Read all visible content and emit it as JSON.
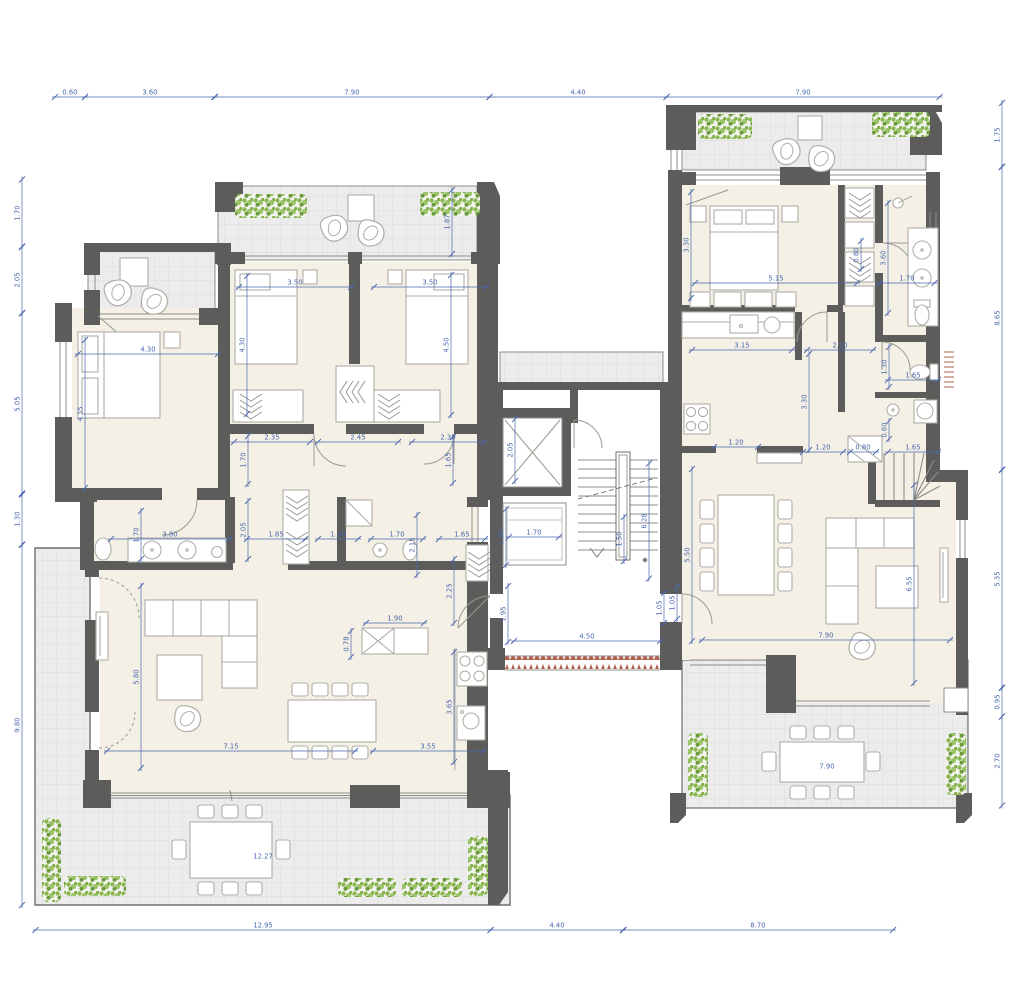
{
  "title": "apartment-floor-plan",
  "colors": {
    "wall": "#5c5c5b",
    "floor": "#f4f0e5",
    "terrace": "#ececec",
    "terrace_grid": "#dcdcdc",
    "furniture_stroke": "#aeaea6",
    "window_line": "#8c8c88",
    "dimension_blue": "#4a68ae",
    "plant_green": "#8ab74f",
    "plant_green_dark": "#6b9a3c",
    "hatch_red": "#b2604e"
  },
  "dimensions": [
    {
      "t": "0.60",
      "x": 70,
      "y": 97,
      "len": 30,
      "v": 0
    },
    {
      "t": "3.60",
      "x": 150,
      "y": 97,
      "len": 130,
      "v": 0
    },
    {
      "t": "7.90",
      "x": 352,
      "y": 97,
      "len": 275,
      "v": 0
    },
    {
      "t": "4.40",
      "x": 578,
      "y": 97,
      "len": 177,
      "v": 0
    },
    {
      "t": "7.90",
      "x": 803,
      "y": 97,
      "len": 273,
      "v": 0
    },
    {
      "t": "12.95",
      "x": 263,
      "y": 930,
      "len": 455,
      "v": 0
    },
    {
      "t": "4.40",
      "x": 557,
      "y": 930,
      "len": 133,
      "v": 0
    },
    {
      "t": "8.70",
      "x": 758,
      "y": 930,
      "len": 270,
      "v": 0
    },
    {
      "t": "1.70",
      "x": 22,
      "y": 213,
      "len": 67,
      "v": 1
    },
    {
      "t": "2.05",
      "x": 22,
      "y": 280,
      "len": 66,
      "v": 1
    },
    {
      "t": "5.05",
      "x": 22,
      "y": 404,
      "len": 181,
      "v": 1
    },
    {
      "t": "1.30",
      "x": 22,
      "y": 519,
      "len": 51,
      "v": 1
    },
    {
      "t": "9.80",
      "x": 22,
      "y": 725,
      "len": 360,
      "v": 1
    },
    {
      "t": "1.75",
      "x": 1002,
      "y": 135,
      "len": 64,
      "v": 1
    },
    {
      "t": "8.65",
      "x": 1002,
      "y": 318,
      "len": 303,
      "v": 1
    },
    {
      "t": "5.35",
      "x": 1002,
      "y": 579,
      "len": 218,
      "v": 1
    },
    {
      "t": "0.95",
      "x": 1002,
      "y": 702,
      "len": 29,
      "v": 1
    },
    {
      "t": "2.70",
      "x": 1002,
      "y": 761,
      "len": 89,
      "v": 1
    },
    {
      "t": "1.87",
      "x": 452,
      "y": 222,
      "len": 64,
      "v": 1
    },
    {
      "t": "3.50",
      "x": 295,
      "y": 287,
      "len": 112,
      "v": 0
    },
    {
      "t": "3.50",
      "x": 430,
      "y": 287,
      "len": 112,
      "v": 0
    },
    {
      "t": "4.30",
      "x": 148,
      "y": 354,
      "len": 140,
      "v": 0
    },
    {
      "t": "4.35",
      "x": 85,
      "y": 414,
      "len": 148,
      "v": 1
    },
    {
      "t": "4.30",
      "x": 247,
      "y": 345,
      "len": 138,
      "v": 1
    },
    {
      "t": "4.50",
      "x": 451,
      "y": 345,
      "len": 140,
      "v": 1
    },
    {
      "t": "2.35",
      "x": 272,
      "y": 442,
      "len": 76,
      "v": 0
    },
    {
      "t": "2.45",
      "x": 358,
      "y": 442,
      "len": 80,
      "v": 0
    },
    {
      "t": "2.30",
      "x": 448,
      "y": 442,
      "len": 72,
      "v": 0
    },
    {
      "t": "1.70",
      "x": 248,
      "y": 460,
      "len": 48,
      "v": 1
    },
    {
      "t": "1.65",
      "x": 453,
      "y": 460,
      "len": 46,
      "v": 1
    },
    {
      "t": "1.70",
      "x": 141,
      "y": 535,
      "len": 48,
      "v": 1
    },
    {
      "t": "3.80",
      "x": 170,
      "y": 539,
      "len": 118,
      "v": 0
    },
    {
      "t": "2.05",
      "x": 248,
      "y": 530,
      "len": 58,
      "v": 1
    },
    {
      "t": "1.85",
      "x": 276,
      "y": 539,
      "len": 58,
      "v": 0
    },
    {
      "t": "1.30",
      "x": 338,
      "y": 539,
      "len": 40,
      "v": 0
    },
    {
      "t": "1.70",
      "x": 397,
      "y": 539,
      "len": 52,
      "v": 0
    },
    {
      "t": "2.15",
      "x": 417,
      "y": 545,
      "len": 60,
      "v": 1
    },
    {
      "t": "1.65",
      "x": 462,
      "y": 539,
      "len": 46,
      "v": 0
    },
    {
      "t": "1.90",
      "x": 506,
      "y": 537,
      "len": 56,
      "v": 1
    },
    {
      "t": "1.70",
      "x": 534,
      "y": 537,
      "len": 50,
      "v": 0
    },
    {
      "t": "2.05",
      "x": 515,
      "y": 450,
      "len": 62,
      "v": 1
    },
    {
      "t": "1.50",
      "x": 624,
      "y": 539,
      "len": 44,
      "v": 1
    },
    {
      "t": "6.28",
      "x": 649,
      "y": 521,
      "len": 115,
      "v": 1
    },
    {
      "t": "5.80",
      "x": 141,
      "y": 677,
      "len": 182,
      "v": 1
    },
    {
      "t": "1.90",
      "x": 395,
      "y": 623,
      "len": 58,
      "v": 0
    },
    {
      "t": "0.78",
      "x": 351,
      "y": 644,
      "len": 26,
      "v": 1
    },
    {
      "t": "2.25",
      "x": 454,
      "y": 591,
      "len": 64,
      "v": 1
    },
    {
      "t": "3.65",
      "x": 454,
      "y": 707,
      "len": 110,
      "v": 1
    },
    {
      "t": "7.15",
      "x": 231,
      "y": 751,
      "len": 248,
      "v": 0
    },
    {
      "t": "3.55",
      "x": 428,
      "y": 751,
      "len": 110,
      "v": 0
    },
    {
      "t": "1.95",
      "x": 508,
      "y": 614,
      "len": 56,
      "v": 1
    },
    {
      "t": "4.50",
      "x": 587,
      "y": 641,
      "len": 146,
      "v": 0
    },
    {
      "t": "1.05",
      "x": 664,
      "y": 608,
      "len": 30,
      "v": 1
    },
    {
      "t": "12.27",
      "x": 263,
      "y": 861,
      "len": 0,
      "v": 0
    },
    {
      "t": "3.30",
      "x": 691,
      "y": 245,
      "len": 106,
      "v": 1
    },
    {
      "t": "5.15",
      "x": 776,
      "y": 283,
      "len": 162,
      "v": 0
    },
    {
      "t": "0.80",
      "x": 861,
      "y": 255,
      "len": 28,
      "v": 1
    },
    {
      "t": "3.60",
      "x": 888,
      "y": 258,
      "len": 110,
      "v": 1
    },
    {
      "t": "1.70",
      "x": 907,
      "y": 283,
      "len": 55,
      "v": 0
    },
    {
      "t": "3.15",
      "x": 742,
      "y": 350,
      "len": 100,
      "v": 0
    },
    {
      "t": "2.10",
      "x": 840,
      "y": 350,
      "len": 66,
      "v": 0
    },
    {
      "t": "1.30",
      "x": 889,
      "y": 367,
      "len": 40,
      "v": 1
    },
    {
      "t": "1.65",
      "x": 913,
      "y": 380,
      "len": 50,
      "v": 0
    },
    {
      "t": "1.20",
      "x": 736,
      "y": 447,
      "len": 44,
      "v": 0
    },
    {
      "t": "1.20",
      "x": 823,
      "y": 452,
      "len": 40,
      "v": 0
    },
    {
      "t": "0.80",
      "x": 863,
      "y": 452,
      "len": 26,
      "v": 0
    },
    {
      "t": "1.65",
      "x": 913,
      "y": 452,
      "len": 50,
      "v": 0
    },
    {
      "t": "3.30",
      "x": 809,
      "y": 402,
      "len": 96,
      "v": 1
    },
    {
      "t": "0.60",
      "x": 889,
      "y": 430,
      "len": 18,
      "v": 1
    },
    {
      "t": "5.50",
      "x": 692,
      "y": 555,
      "len": 172,
      "v": 1
    },
    {
      "t": "1.05",
      "x": 677,
      "y": 603,
      "len": 32,
      "v": 1
    },
    {
      "t": "7.90",
      "x": 826,
      "y": 640,
      "len": 248,
      "v": 0
    },
    {
      "t": "6.55",
      "x": 914,
      "y": 584,
      "len": 198,
      "v": 1
    },
    {
      "t": "7.90",
      "x": 827,
      "y": 771,
      "len": 0,
      "v": 0
    }
  ]
}
